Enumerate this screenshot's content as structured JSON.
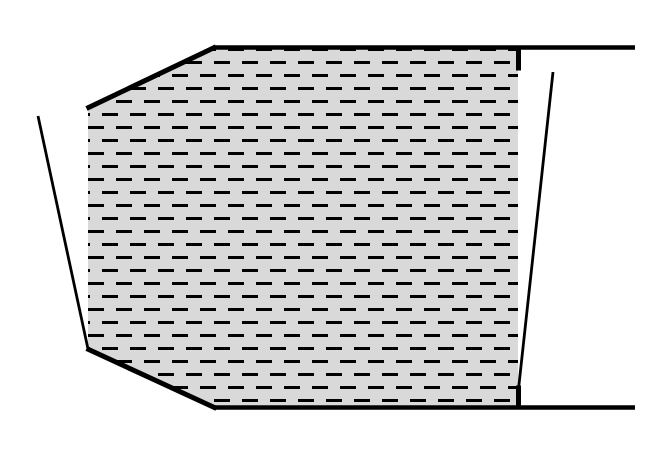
{
  "canvas": {
    "width": 670,
    "height": 465,
    "background": "#ffffff"
  },
  "diagram": {
    "description": "hatched-trapezoidal-region-between-walls",
    "line_color": "#000000",
    "region": {
      "name": "hatched-region",
      "fill": "#d9d9d9",
      "points": [
        [
          88,
          107
        ],
        [
          215,
          46.5
        ],
        [
          518,
          46.5
        ],
        [
          518,
          409
        ],
        [
          215,
          409
        ],
        [
          88,
          350
        ]
      ]
    },
    "hatch": {
      "name": "horizontal-dash-hatch",
      "dash_color": "#000000",
      "dash_length": 16,
      "dash_gap": 12,
      "dash_thickness": 3,
      "row_spacing": 13,
      "row_offset": 14,
      "origin": [
        4,
        48
      ]
    },
    "lines": [
      {
        "name": "top-left-slope-edge",
        "from": [
          86.5,
          108.5
        ],
        "to": [
          216,
          46.8
        ],
        "width": 5
      },
      {
        "name": "top-boundary-line",
        "from": [
          213,
          47.5
        ],
        "to": [
          635,
          47.5
        ],
        "width": 4.5
      },
      {
        "name": "top-right-wall-stub",
        "from": [
          518.5,
          45.5
        ],
        "to": [
          518.5,
          70.5
        ],
        "width": 5
      },
      {
        "name": "right-wall-line",
        "from": [
          553,
          72
        ],
        "to": [
          518.5,
          389
        ],
        "width": 2.8
      },
      {
        "name": "bottom-right-wall-stub",
        "from": [
          518.5,
          385.5
        ],
        "to": [
          518.5,
          409.5
        ],
        "width": 5
      },
      {
        "name": "bottom-boundary-line",
        "from": [
          213,
          407.5
        ],
        "to": [
          635,
          407.5
        ],
        "width": 4.5
      },
      {
        "name": "bottom-left-slope-edge",
        "from": [
          86.5,
          348.5
        ],
        "to": [
          216.5,
          408.5
        ],
        "width": 5
      },
      {
        "name": "left-wall-line",
        "from": [
          38,
          116
        ],
        "to": [
          88,
          349
        ],
        "width": 2.8
      }
    ]
  }
}
